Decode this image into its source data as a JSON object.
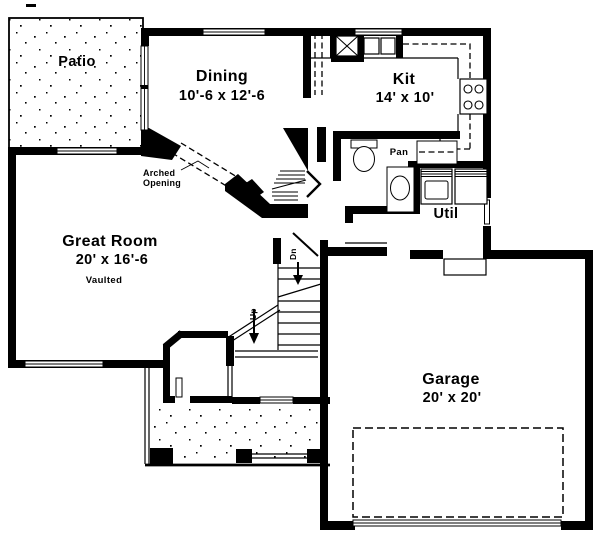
{
  "colors": {
    "ink": "#000000",
    "paper": "#ffffff"
  },
  "rooms": {
    "patio": {
      "name": "Patio"
    },
    "dining": {
      "name": "Dining",
      "dims": "10'-6 x 12'-6"
    },
    "kitchen": {
      "name": "Kit",
      "dims": "14' x 10'"
    },
    "great_room": {
      "name": "Great Room",
      "dims": "20' x 16'-6",
      "note": "Vaulted"
    },
    "garage": {
      "name": "Garage",
      "dims": "20' x 20'"
    },
    "utility": {
      "name": "Util"
    },
    "pantry": {
      "name": "Pan"
    }
  },
  "annotations": {
    "arched_opening_line1": "Arched",
    "arched_opening_line2": "Opening",
    "stairs_down_label": "Dn",
    "stairs_up_label": "Up"
  }
}
